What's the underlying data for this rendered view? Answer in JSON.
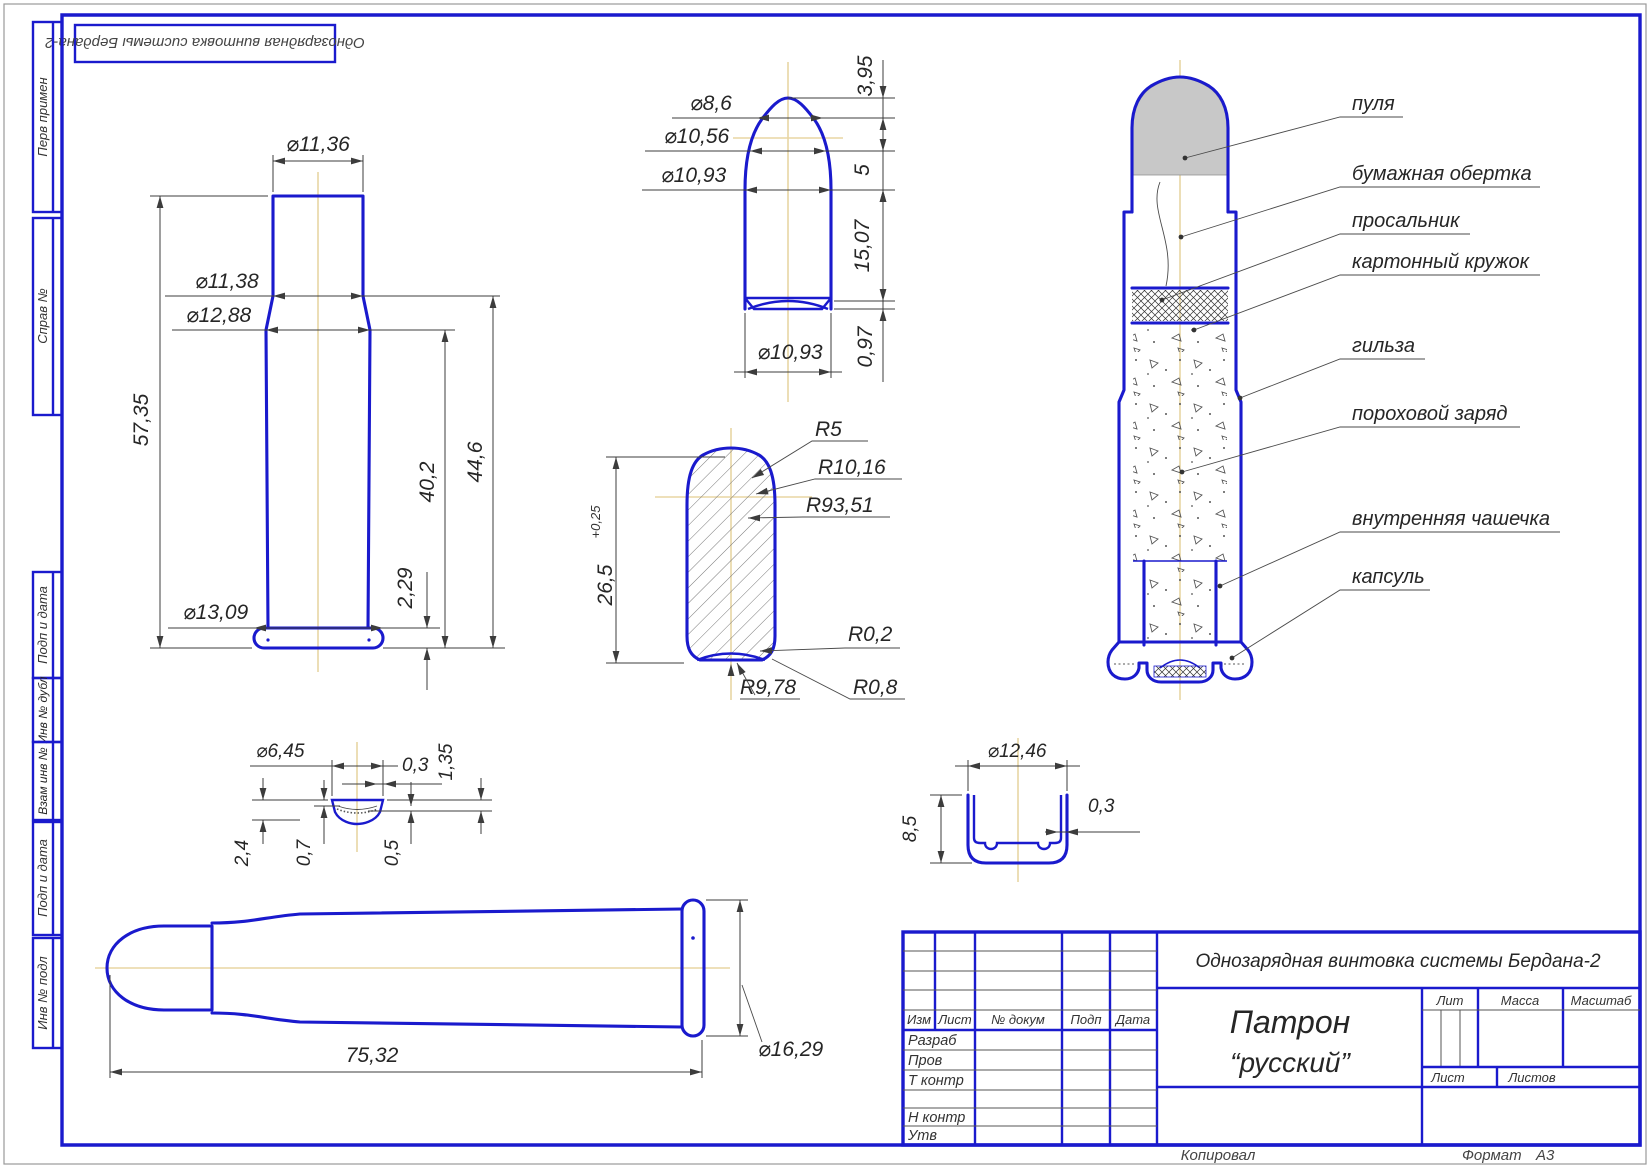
{
  "stamp_top": "Однозарядная винтовка системы Бердана-2",
  "sidebar": {
    "items": [
      "Перв примен",
      "Справ №",
      "Подп и дата",
      "Инв № дубл",
      "Взам инв №",
      "Подп и дата",
      "Инв № подл"
    ]
  },
  "views": {
    "case": {
      "dims": {
        "d1": "⌀11,36",
        "d2": "⌀11,38",
        "d3": "⌀12,88",
        "h1": "57,35",
        "h2": "40,2",
        "h3": "44,6",
        "t1": "2,29",
        "d4": "⌀13,09"
      }
    },
    "bullet": {
      "dims": {
        "d1": "⌀8,6",
        "d2": "⌀10,56",
        "d3": "⌀10,93",
        "h1": "3,95",
        "h2": "5",
        "h3": "15,07",
        "h4": "0,97",
        "d4": "⌀10,93"
      }
    },
    "section": {
      "dims": {
        "h": "26,5",
        "tol": "+0,25",
        "r1": "R5",
        "r2": "R10,16",
        "r3": "R93,51",
        "r4": "R0,2",
        "r5": "R9,78",
        "r6": "R0,8"
      }
    },
    "cartridge": {
      "labels": [
        "пуля",
        "бумажная обертка",
        "просальник",
        "картонный кружок",
        "гильза",
        "пороховой заряд",
        "внутренняя чашечка",
        "капсуль"
      ]
    },
    "cap": {
      "dims": {
        "d1": "⌀6,45",
        "w1": "0,3",
        "h1": "1,35",
        "h2": "2,4",
        "h3": "0,7",
        "h4": "0,5"
      }
    },
    "cup": {
      "dims": {
        "d1": "⌀12,46",
        "h1": "8,5",
        "w1": "0,3"
      }
    },
    "profile": {
      "dims": {
        "l1": "75,32",
        "d1": "⌀16,29"
      }
    }
  },
  "title_block": {
    "doc_title": "Однозарядная винтовка системы Бердана-2",
    "part_line1": "Патрон",
    "part_line2": "“русский”",
    "rev_headers": [
      "Изм",
      "Лист",
      "№ докум",
      "Подп",
      "Дата"
    ],
    "sign_labels": [
      "Разраб",
      "Пров",
      "Т контр",
      "Н контр",
      "Утв"
    ],
    "lit": "Лит",
    "mass": "Масса",
    "scale": "Масштаб",
    "sheet": "Лист",
    "sheets": "Листов",
    "copied": "Копировал",
    "format_label": "Формат",
    "format_value": "А3"
  }
}
